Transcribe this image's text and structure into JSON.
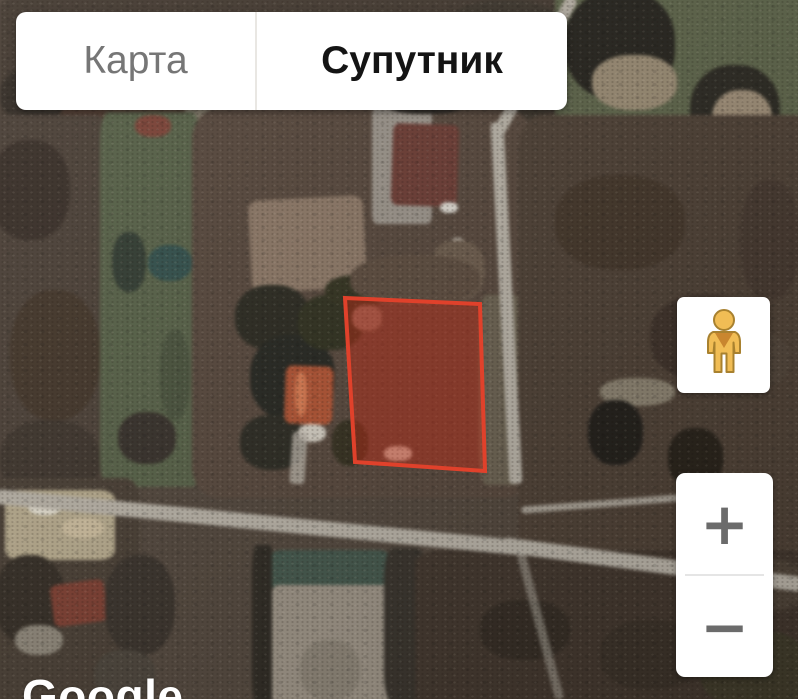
{
  "map_type_control": {
    "tabs": [
      {
        "label": "Карта",
        "active": false
      },
      {
        "label": "Супутник",
        "active": true
      }
    ]
  },
  "street_view_control": {
    "icon": "pegman-icon"
  },
  "zoom_control": {
    "zoom_in_label": "+",
    "zoom_out_label": "−"
  },
  "attribution": {
    "logo_text": "Google"
  },
  "selected_plot": {
    "points": "345,298 480,304 485,471 355,462",
    "stroke_color": "#e0412b",
    "fill_color": "rgba(199,44,22,0.42)",
    "stroke_width": 4
  }
}
